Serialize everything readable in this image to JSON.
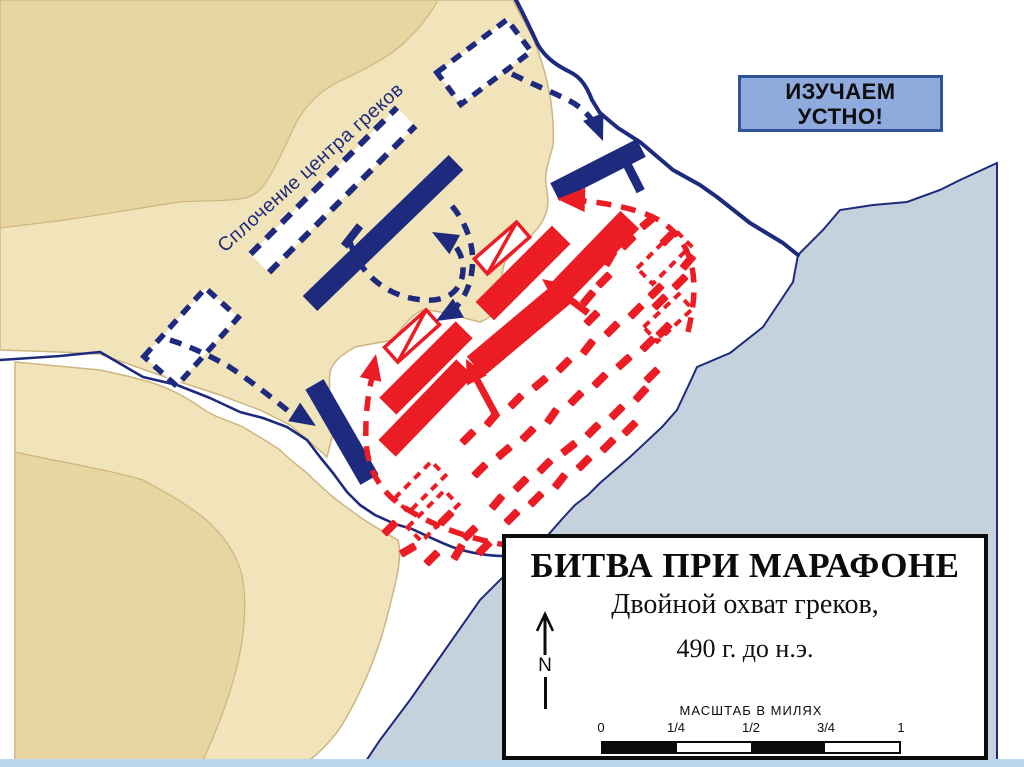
{
  "badge": {
    "line1": "ИЗУЧАЕМ",
    "line2": "УСТНО!"
  },
  "map_label": "Сплочение центра греков",
  "legend": {
    "title": "БИТВА ПРИ МАРАФОНЕ",
    "subtitle": "Двойной охват греков,",
    "date": "490 г. до н.э.",
    "north_letter": "N",
    "scale": {
      "label": "МАСШТАБ В МИЛЯХ",
      "ticks": [
        "0",
        "1/4",
        "1/2",
        "3/4",
        "1"
      ],
      "segments": [
        "#0a0a0a",
        "#ffffff",
        "#0a0a0a",
        "#ffffff"
      ]
    }
  },
  "colors": {
    "navy": "#1d2a7d",
    "red": "#ec1c24",
    "land_light": "#f1e3ba",
    "land_dark": "#e8d6a2",
    "land_edge": "#cdb67f",
    "sea_fill": "#c6d1de",
    "bottom_strip": "#bcd6ee",
    "white": "#ffffff"
  },
  "map": {
    "terrain": [
      {
        "name": "sea",
        "fill": "#c6d1de",
        "stroke": "#1d2a7d",
        "sw": 2,
        "d": "M 997,163 L 960,180 940,190 907,202 873,205 840,210 823,230 798,255 793,282 763,327 730,353 697,367 692,378 677,410 662,427 630,457 600,483 588,495 575,505 563,518 548,535 520,560 480,600 445,650 410,700 380,740 362,767 L 997,767 Z"
      },
      {
        "name": "land-main",
        "fill": "#f1e3ba",
        "stroke": "#cdb67f",
        "sw": 1.5,
        "d": "M 0,0 L 513,0 C 520,15 528,28 534,40 C 540,55 546,75 550,95 C 553,115 554,130 553,145 C 550,160 544,170 546,185 C 549,200 549,210 542,222 C 534,235 518,248 505,262 C 500,275 503,288 503,300 C 498,312 490,318 480,322 C 462,318 440,310 422,310 C 408,318 400,330 393,340 L 355,347 C 345,353 333,360 330,372 C 328,395 332,415 334,430 L 327,457 L 310,442 290,425 260,410 220,395 180,382 145,370 100,354 60,352 0,350 Z"
      },
      {
        "name": "hill-top-left",
        "fill": "#e8d6a2",
        "stroke": "#cdb67f",
        "sw": 1.2,
        "d": "M 0,0 L 438,0 C 430,15 420,28 405,42 C 388,58 360,72 338,82 C 322,90 305,105 295,125 C 287,142 280,158 272,172 C 265,185 258,195 245,198 C 225,202 200,200 180,202 C 140,208 100,215 65,220 L 0,228 Z"
      },
      {
        "name": "land-south",
        "fill": "#f1e3ba",
        "stroke": "#cdb67f",
        "sw": 1.5,
        "d": "M 15,362 L 100,370 C 135,378 165,382 200,407 C 215,418 228,420 243,427 C 258,436 268,442 280,450 C 290,460 297,465 307,473 C 317,483 325,490 333,497 C 343,505 352,511 360,517 C 370,524 380,530 398,540 C 402,555 398,575 390,605 C 382,640 368,680 345,720 C 332,742 315,757 300,767 L 15,767 Z"
      },
      {
        "name": "hill-bottom-left",
        "fill": "#e8d6a2",
        "stroke": "#cdb67f",
        "sw": 1.2,
        "d": "M 15,452 C 60,462 110,470 143,480 C 165,492 180,500 196,512 C 215,525 235,548 242,575 C 248,605 244,645 232,685 C 222,718 210,745 200,767 L 15,767 Z"
      }
    ],
    "waterlines": [
      {
        "name": "river",
        "color": "#1d2a7d",
        "w": 2.6,
        "d": "M 0,360 L 60,356 100,352 L 143,377 177,385 210,398 240,412 263,418 287,427 307,440 320,457 333,473 347,492 360,505 375,515 395,524 412,529 C 425,535 445,545 458,549 C 472,553 488,556 505,556"
      },
      {
        "name": "shore-cliff-line",
        "color": "#1d2a7d",
        "w": 4,
        "d": "M 516,0 C 524,15 530,28 538,45 C 547,60 560,67 570,72 C 578,76 585,82 592,100 L 600,113 618,128 640,142 673,170 700,185 717,197 750,223 783,243 798,255"
      }
    ],
    "band": {
      "name": "greek-center-column-marker",
      "x": 333,
      "y": 190,
      "w": 207,
      "h": 26,
      "rot": -45,
      "fill": "#ffffff",
      "color": "#1d2a7d",
      "lw": 6,
      "dash": "13 9"
    },
    "dashed_units": [
      {
        "name": "greek-reserve-dashed-unit",
        "x": 484,
        "y": 62,
        "w": 88,
        "h": 40,
        "rot": -37,
        "color": "#1d2a7d",
        "lw": 5.5,
        "dash": "11 8",
        "fill": "#ffffff"
      },
      {
        "name": "greek-reserve-dashed-unit",
        "x": 191,
        "y": 337,
        "w": 92,
        "h": 44,
        "rot": -48,
        "color": "#1d2a7d",
        "lw": 5.5,
        "dash": "11 8",
        "fill": "#ffffff"
      },
      {
        "name": "persian-routed-dashed-unit",
        "x": 420,
        "y": 487,
        "w": 52,
        "h": 20,
        "rot": -45,
        "color": "#ec1c24",
        "lw": 4,
        "dash": "8 6",
        "fill": "none"
      },
      {
        "name": "persian-routed-dashed-unit",
        "x": 433,
        "y": 516,
        "w": 52,
        "h": 20,
        "rot": -45,
        "color": "#ec1c24",
        "lw": 4,
        "dash": "8 6",
        "fill": "none"
      },
      {
        "name": "persian-routed-dashed-unit",
        "x": 664,
        "y": 257,
        "w": 54,
        "h": 22,
        "rot": -45,
        "color": "#ec1c24",
        "lw": 4,
        "dash": "8 6",
        "fill": "none"
      },
      {
        "name": "persian-routed-dashed-unit",
        "x": 668,
        "y": 318,
        "w": 48,
        "h": 20,
        "rot": -43,
        "color": "#ec1c24",
        "lw": 4,
        "dash": "8 6",
        "fill": "none"
      }
    ],
    "unit_bars": [
      {
        "name": "persian-line-bar",
        "x": 523,
        "y": 273,
        "w": 108,
        "h": 26,
        "rot": -45,
        "color": "#ec1c24"
      },
      {
        "name": "persian-line-bar",
        "x": 593,
        "y": 258,
        "w": 106,
        "h": 26,
        "rot": -46,
        "color": "#ec1c24"
      },
      {
        "name": "persian-line-bar",
        "x": 520,
        "y": 329,
        "w": 117,
        "h": 26,
        "rot": -40,
        "color": "#ec1c24"
      },
      {
        "name": "persian-line-bar",
        "x": 426,
        "y": 368,
        "w": 108,
        "h": 24,
        "rot": -45,
        "color": "#ec1c24"
      },
      {
        "name": "persian-line-bar",
        "x": 426,
        "y": 408,
        "w": 112,
        "h": 24,
        "rot": -46,
        "color": "#ec1c24"
      },
      {
        "name": "greek-line-bar",
        "x": 383,
        "y": 233,
        "w": 203,
        "h": 21,
        "rot": -44,
        "color": "#1d2a7d"
      },
      {
        "name": "greek-wing-bar",
        "x": 598,
        "y": 170,
        "w": 97,
        "h": 20,
        "rot": -27,
        "color": "#1d2a7d"
      },
      {
        "name": "greek-wing-bar",
        "x": 342,
        "y": 432,
        "w": 110,
        "h": 21,
        "rot": 60,
        "color": "#1d2a7d"
      },
      {
        "name": "greek-unit-tick",
        "x": 352,
        "y": 236,
        "w": 26,
        "h": 8,
        "rot": -52,
        "color": "#1d2a7d"
      },
      {
        "name": "greek-unit-tick",
        "x": 633,
        "y": 176,
        "w": 9,
        "h": 34,
        "rot": -27,
        "color": "#1d2a7d"
      }
    ],
    "cavalry": [
      {
        "name": "persian-cavalry-symbol",
        "x": 502,
        "y": 248,
        "w": 56,
        "h": 20,
        "rot": -41,
        "color": "#ec1c24"
      },
      {
        "name": "persian-cavalry-symbol",
        "x": 412,
        "y": 336,
        "w": 56,
        "h": 20,
        "rot": -42,
        "color": "#ec1c24"
      }
    ],
    "rout_field": [
      [
        468,
        437,
        -45
      ],
      [
        492,
        419,
        -50
      ],
      [
        516,
        401,
        -45
      ],
      [
        540,
        383,
        -40
      ],
      [
        564,
        365,
        -45
      ],
      [
        588,
        347,
        -52
      ],
      [
        612,
        329,
        -45
      ],
      [
        636,
        311,
        -45
      ],
      [
        656,
        291,
        -45
      ],
      [
        480,
        470,
        -45
      ],
      [
        504,
        452,
        -40
      ],
      [
        528,
        434,
        -45
      ],
      [
        552,
        416,
        -55
      ],
      [
        576,
        398,
        -45
      ],
      [
        600,
        380,
        -45
      ],
      [
        624,
        362,
        -42
      ],
      [
        648,
        344,
        -45
      ],
      [
        497,
        502,
        -50
      ],
      [
        521,
        484,
        -45
      ],
      [
        545,
        466,
        -45
      ],
      [
        569,
        448,
        -38
      ],
      [
        593,
        430,
        -45
      ],
      [
        617,
        412,
        -45
      ],
      [
        641,
        394,
        -48
      ],
      [
        652,
        375,
        -45
      ],
      [
        512,
        517,
        -45
      ],
      [
        536,
        499,
        -45
      ],
      [
        560,
        481,
        -52
      ],
      [
        584,
        463,
        -45
      ],
      [
        608,
        445,
        -45
      ],
      [
        630,
        428,
        -45
      ],
      [
        664,
        330,
        -45
      ],
      [
        628,
        242,
        -45
      ],
      [
        648,
        222,
        -40
      ],
      [
        668,
        238,
        -45
      ],
      [
        688,
        262,
        -50
      ],
      [
        680,
        282,
        -45
      ],
      [
        660,
        302,
        -45
      ],
      [
        604,
        280,
        -45
      ],
      [
        588,
        298,
        -50
      ],
      [
        610,
        258,
        -60
      ],
      [
        592,
        318,
        -45
      ],
      [
        390,
        528,
        -45
      ],
      [
        408,
        550,
        -30
      ],
      [
        432,
        558,
        -45
      ],
      [
        458,
        552,
        -60
      ],
      [
        470,
        533,
        -45
      ],
      [
        484,
        548,
        -45
      ],
      [
        446,
        518,
        -45
      ]
    ],
    "arrows": [
      {
        "name": "greek-advance-arrow",
        "color": "#1d2a7d",
        "w": 5.5,
        "dash": "12 9",
        "path": "M 512,74 C 532,84 552,92 568,100 C 582,107 591,117 597,128",
        "head": [
          603,
          141,
          68,
          26,
          11
        ]
      },
      {
        "name": "greek-advance-arrow",
        "color": "#1d2a7d",
        "w": 5.5,
        "dash": "12 9",
        "path": "M 170,340 C 192,347 212,357 228,366 C 248,379 270,396 292,414",
        "head": [
          316,
          426,
          33,
          26,
          11
        ]
      },
      {
        "name": "greek-envelop-arrow",
        "color": "#1d2a7d",
        "w": 5.5,
        "dash": "12 9",
        "path": "M 350,242 C 360,276 390,298 424,300 C 450,302 464,288 463,266 C 462,256 458,248 452,243",
        "head": [
          432,
          232,
          -151,
          26,
          11
        ]
      },
      {
        "name": "greek-envelop-arrow",
        "color": "#1d2a7d",
        "w": 5.5,
        "dash": "12 9",
        "path": "M 452,206 C 467,224 475,247 472,270 C 470,288 462,303 450,313",
        "head": [
          436,
          321,
          150,
          26,
          11
        ]
      },
      {
        "name": "persian-retreat-arc",
        "color": "#ec1c24",
        "w": 5.5,
        "dash": "15 10",
        "path": "M 512,546 C 472,540 432,526 402,506 C 380,491 368,470 366,442 C 365,417 368,392 373,374",
        "head": [
          376,
          354,
          -78,
          26,
          11
        ]
      },
      {
        "name": "persian-retreat-arc",
        "color": "#ec1c24",
        "w": 5.5,
        "dash": "15 10",
        "path": "M 688,332 C 693,310 697,286 691,263 C 684,236 665,219 637,211 C 617,205 597,202 576,200",
        "head": [
          557,
          199,
          -178,
          28,
          12
        ]
      },
      {
        "name": "persian-attack-arrow",
        "color": "#ec1c24",
        "w": 7,
        "shaft": [
          588,
          313,
          556,
          289
        ],
        "head": [
          542,
          279,
          -143,
          24,
          11
        ]
      },
      {
        "name": "persian-attack-arrow",
        "color": "#ec1c24",
        "w": 7,
        "shaft": [
          497,
          417,
          476,
          378
        ],
        "head": [
          466,
          359,
          -117,
          24,
          11
        ]
      }
    ],
    "bottom_strip": {
      "name": "slide-bottom-strip",
      "x": 0,
      "y": 759,
      "w": 1024,
      "h": 8,
      "fill": "#bcd6ee"
    }
  }
}
